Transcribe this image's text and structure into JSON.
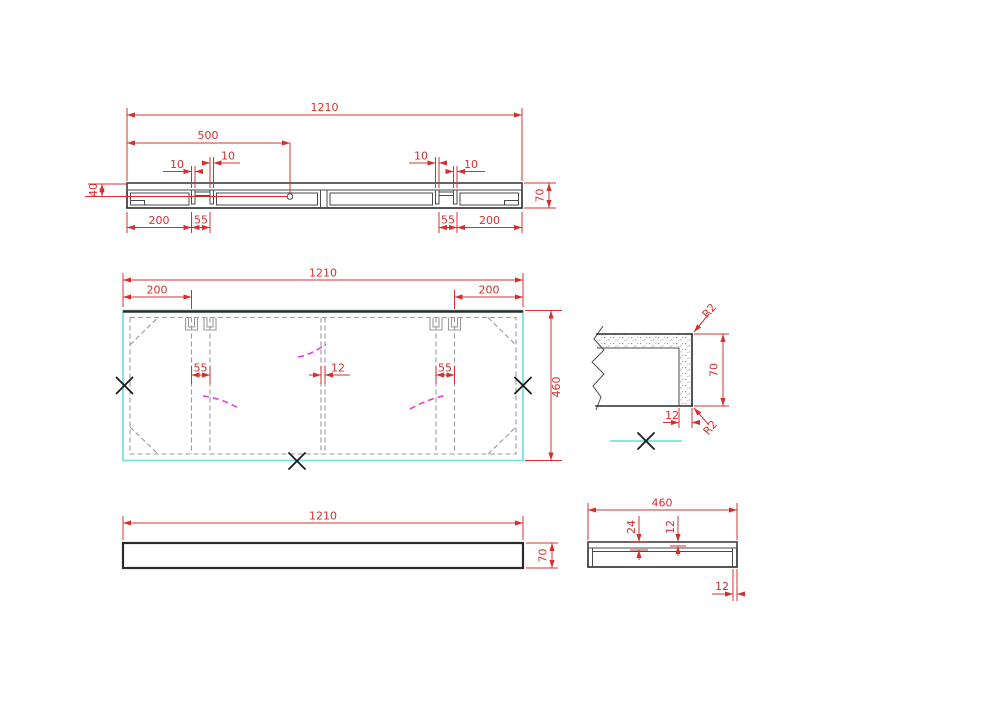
{
  "drawing": {
    "background": "#ffffff",
    "colors": {
      "dimension": "#d43030",
      "outline": "#2b2b2b",
      "inner": "#4a4a4a",
      "hidden": "#9a9a9a",
      "highlight": "#7ce2e2",
      "magenta": "#e23fe2",
      "speckle": "#8f8f8f",
      "mark": "#1c1c1c",
      "background": "#ffffff"
    },
    "views": {
      "section": {
        "dims": {
          "overall": "1210",
          "hole_offset": "500",
          "slot_a": "10",
          "slot_b": "10",
          "slot_c": "10",
          "slot_d": "10",
          "end_left": "200",
          "gap_left": "55",
          "gap_right": "55",
          "end_right": "200",
          "depth_left": "40",
          "height": "70"
        }
      },
      "plan": {
        "dims": {
          "overall": "1210",
          "end_left": "200",
          "end_right": "200",
          "rib_left": "55",
          "rib_center": "12",
          "rib_right": "55",
          "depth": "460"
        }
      },
      "detail": {
        "dims": {
          "radius_top": "R2",
          "radius_bottom": "R2",
          "height": "70",
          "skin": "12"
        }
      },
      "front": {
        "dims": {
          "width": "1210",
          "height": "70"
        }
      },
      "side": {
        "dims": {
          "width": "460",
          "recess": "24",
          "skin": "12",
          "edge": "12"
        }
      }
    }
  }
}
